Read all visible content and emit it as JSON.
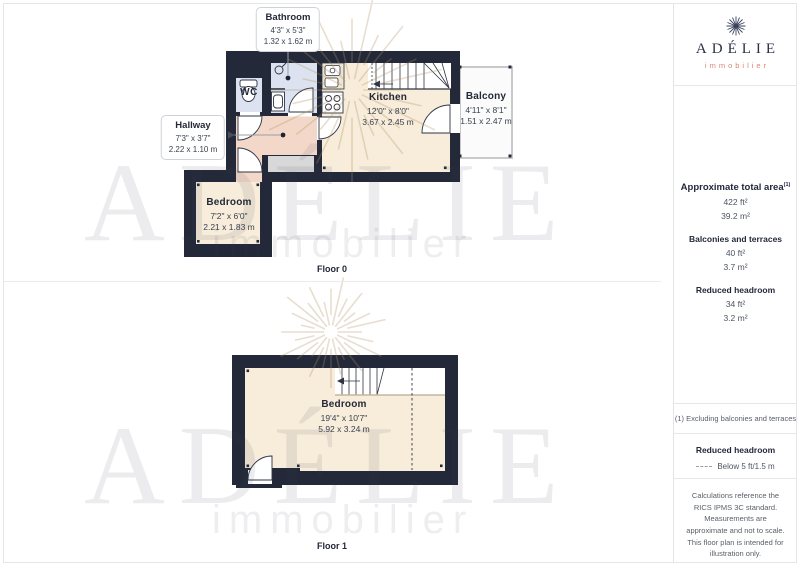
{
  "page": {
    "floor0_label": "Floor 0",
    "floor1_label": "Floor 1"
  },
  "watermark": {
    "title": "ADÉLIE",
    "subtitle": "immobilier"
  },
  "logo": {
    "title": "ADÉLIE",
    "subtitle": "immobilier"
  },
  "colors": {
    "wall": "#232939",
    "floor_cream": "#f7edda",
    "floor_pink": "#f3d8c9",
    "floor_blue": "#dde2f0",
    "accent_salmon": "#dd8570",
    "navy_text": "#232939"
  },
  "floor0": {
    "bathroom_callout": {
      "title": "Bathroom",
      "imperial": "4'3\" x 5'3\"",
      "metric": "1.32 x 1.62 m"
    },
    "hallway_callout": {
      "title": "Hallway",
      "imperial": "7'3\" x 3'7\"",
      "metric": "2.22 x 1.10 m"
    },
    "kitchen": {
      "title": "Kitchen",
      "imperial": "12'0\" x 8'0\"",
      "metric": "3.67 x 2.45 m"
    },
    "balcony": {
      "title": "Balcony",
      "imperial": "4'11\" x 8'1\"",
      "metric": "1.51 x 2.47 m"
    },
    "bedroom": {
      "title": "Bedroom",
      "imperial": "7'2\" x 6'0\"",
      "metric": "2.21 x 1.83 m"
    },
    "wc_label": "WC"
  },
  "floor1": {
    "bedroom": {
      "title": "Bedroom",
      "imperial": "19'4\" x 10'7\"",
      "metric": "5.92 x 3.24 m"
    }
  },
  "sidebar": {
    "area_title": "Approximate total area",
    "area_superscript": "(1)",
    "area_ft": "422 ft²",
    "area_m": "39.2 m²",
    "balconies_title": "Balconies and terraces",
    "balconies_ft": "40 ft²",
    "balconies_m": "3.7 m²",
    "headroom_title": "Reduced headroom",
    "headroom_ft": "34 ft²",
    "headroom_m": "3.2 m²",
    "footnote": "(1) Excluding balconies and terraces",
    "legend_title": "Reduced headroom",
    "legend_item": "Below 5 ft/1.5 m",
    "legal": "Calculations reference the RICS IPMS 3C standard. Measurements are approximate and not to scale. This floor plan is intended for illustration only.",
    "brand_name": "GIRAFFE",
    "brand_number": "360"
  }
}
